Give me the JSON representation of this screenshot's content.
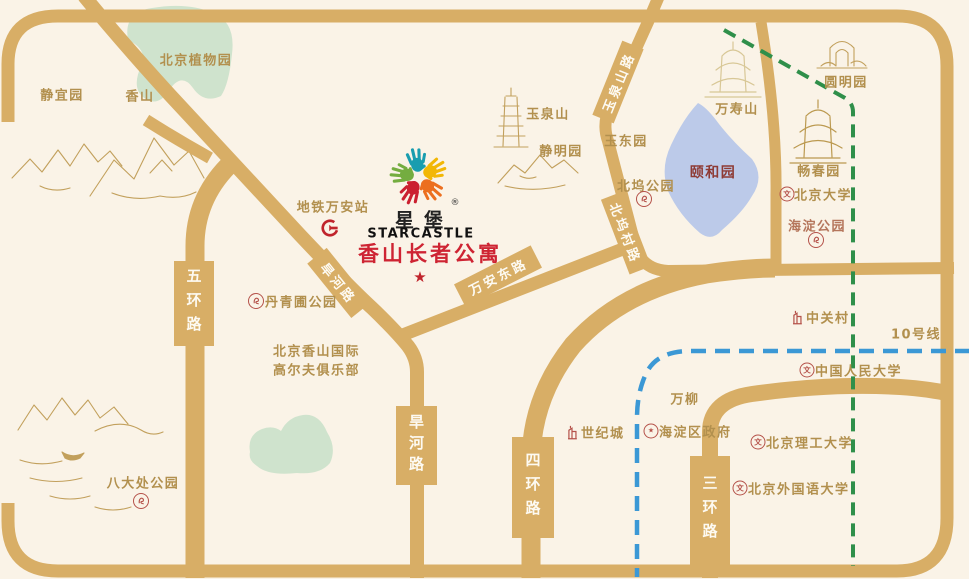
{
  "logo": {
    "name_cn": "星堡",
    "registered": "®",
    "name_en": "STARCASTLE",
    "project": "香山长者公寓",
    "star": "★"
  },
  "roads": {
    "ring5": "五环路",
    "ring4": "四环路",
    "ring3": "三环路",
    "hanhe": "旱河路",
    "wanandong": "万安东路",
    "yuquanshan": "玉泉山路",
    "beiwucun": "北坞村路"
  },
  "subway": {
    "station": "地铁万安站",
    "line10": "10号线"
  },
  "labels": {
    "botanical": "北京植物园",
    "jingyiyuan": "静宜园",
    "xiangshan": "香山",
    "yuquan_hill": "玉泉山",
    "jingmingyuan": "静明园",
    "yudongyuan": "玉东园",
    "wanshoushan": "万寿山",
    "summer_palace": "颐和园",
    "yuanmingyuan": "圆明园",
    "changchunyuan": "畅春园",
    "pku": "北京大学",
    "haidian_park": "海淀公园",
    "beiwu_park": "北坞公园",
    "zhongguancun": "中关村",
    "renmin_univ": "中国人民大学",
    "wanliu": "万柳",
    "century_city": "世纪城",
    "haidian_gov": "海淀区政府",
    "bit_univ": "北京理工大学",
    "bfsu_univ": "北京外国语大学",
    "badachu": "八大处公园",
    "danqingpu": "丹青圃公园",
    "golf_line1": "北京香山国际",
    "golf_line2": "高尔夫俱乐部"
  },
  "icons": {
    "school_glyph": "文",
    "gov_glyph": "★",
    "seal": "seal-stamp-icon",
    "building": "building-icon",
    "subway_logo": "beijing-subway-icon",
    "logo_hands": "starcastle-hands-icon"
  },
  "colors": {
    "background": "#faf3e7",
    "road_gold": "#d8ae66",
    "park_green": "#cfe3cd",
    "lake_blue": "#bccae9",
    "gold_text": "#b2904e",
    "white_road_text": "#fdfaf2",
    "project_red": "#ce2433",
    "summer_palace_red": "#8e3b35",
    "park_label_red": "#b5765c",
    "poi_icon_red": "#b5524a",
    "subway_logo_red": "#c0242c",
    "line10_blue": "#3b98d5",
    "suburban_line_green": "#2f8f4a",
    "sketch_gold": "#c2a05c",
    "hands": [
      "#199daf",
      "#f2b705",
      "#ec6f1f",
      "#cb2030",
      "#74ad40"
    ]
  }
}
